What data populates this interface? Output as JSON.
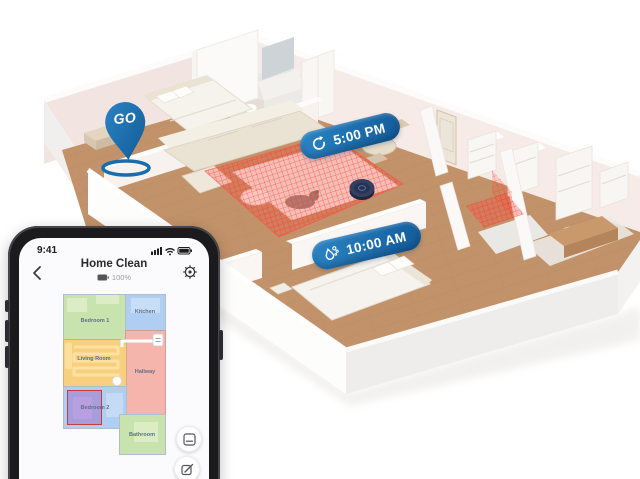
{
  "scene": {
    "go_pin": {
      "label": "GO"
    },
    "schedules": [
      {
        "time": "5:00 PM",
        "icon": "repeat-clean-icon"
      },
      {
        "time": "10:00 AM",
        "icon": "mop-wash-icon"
      }
    ],
    "colors": {
      "badge_blue": "#176ba6",
      "no_go_red": "#ff4434",
      "robot_navy": "#33405f",
      "floor_wood": "#c2936a"
    }
  },
  "phone": {
    "status_bar": {
      "time": "9:41"
    },
    "header": {
      "title": "Home Clean",
      "battery_percent": "100%"
    },
    "map": {
      "rooms": [
        {
          "name": "Bedroom 1",
          "color": "#c9e3ae"
        },
        {
          "name": "Kitchen",
          "color": "#b0cef1"
        },
        {
          "name": "Living Room",
          "color": "#f8cf7e"
        },
        {
          "name": "Hallway",
          "color": "#f6b5ac"
        },
        {
          "name": "Bedroom 2",
          "color": "#b0cef1"
        },
        {
          "name": "Bathroom",
          "color": "#c9e3ae"
        }
      ]
    }
  }
}
